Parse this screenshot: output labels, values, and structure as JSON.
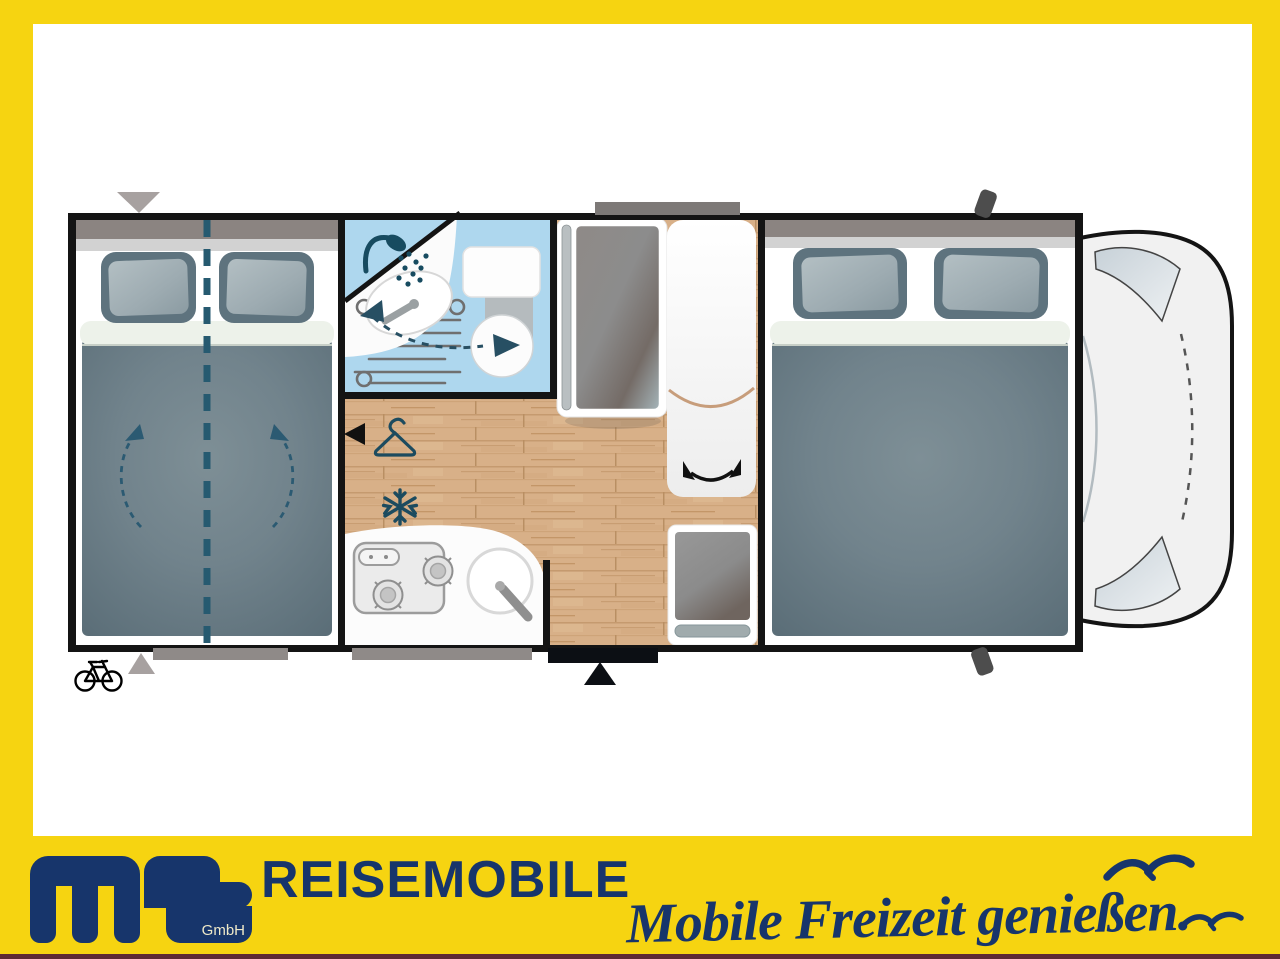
{
  "branding": {
    "logo_text": "ms",
    "logo_suffix": "GmbH",
    "company_name": "REISEMOBILE",
    "slogan": "Mobile Freizeit genießen."
  },
  "palette": {
    "frame_yellow": "#F6D411",
    "brand_navy": "#17356B",
    "footer_rule_maroon": "#5D2A33",
    "bathroom_blue": "#AED7EE",
    "icon_teal": "#1D4F63",
    "wood_floor_tan": "#D8B088",
    "bedding_slate": "#6E8089",
    "wall_black": "#141414"
  },
  "floorplan": {
    "vehicle_type": "motorhome-top-view",
    "rooms": [
      "rear-double-bed",
      "bathroom",
      "kitchen",
      "wardrobe",
      "fridge",
      "front-double-bed",
      "driver-cab"
    ],
    "icons": [
      "shower-icon",
      "washbasin-icon",
      "swivel-toilet-icon",
      "wardrobe-hanger-icon",
      "freezer-snowflake-icon",
      "hob-icon",
      "kitchen-sink-icon",
      "entry-door-marker",
      "bike-rack-icon",
      "bed-fold-arrows",
      "bed-split-line",
      "swivel-arrow",
      "cab-mirror",
      "window-marker"
    ]
  }
}
